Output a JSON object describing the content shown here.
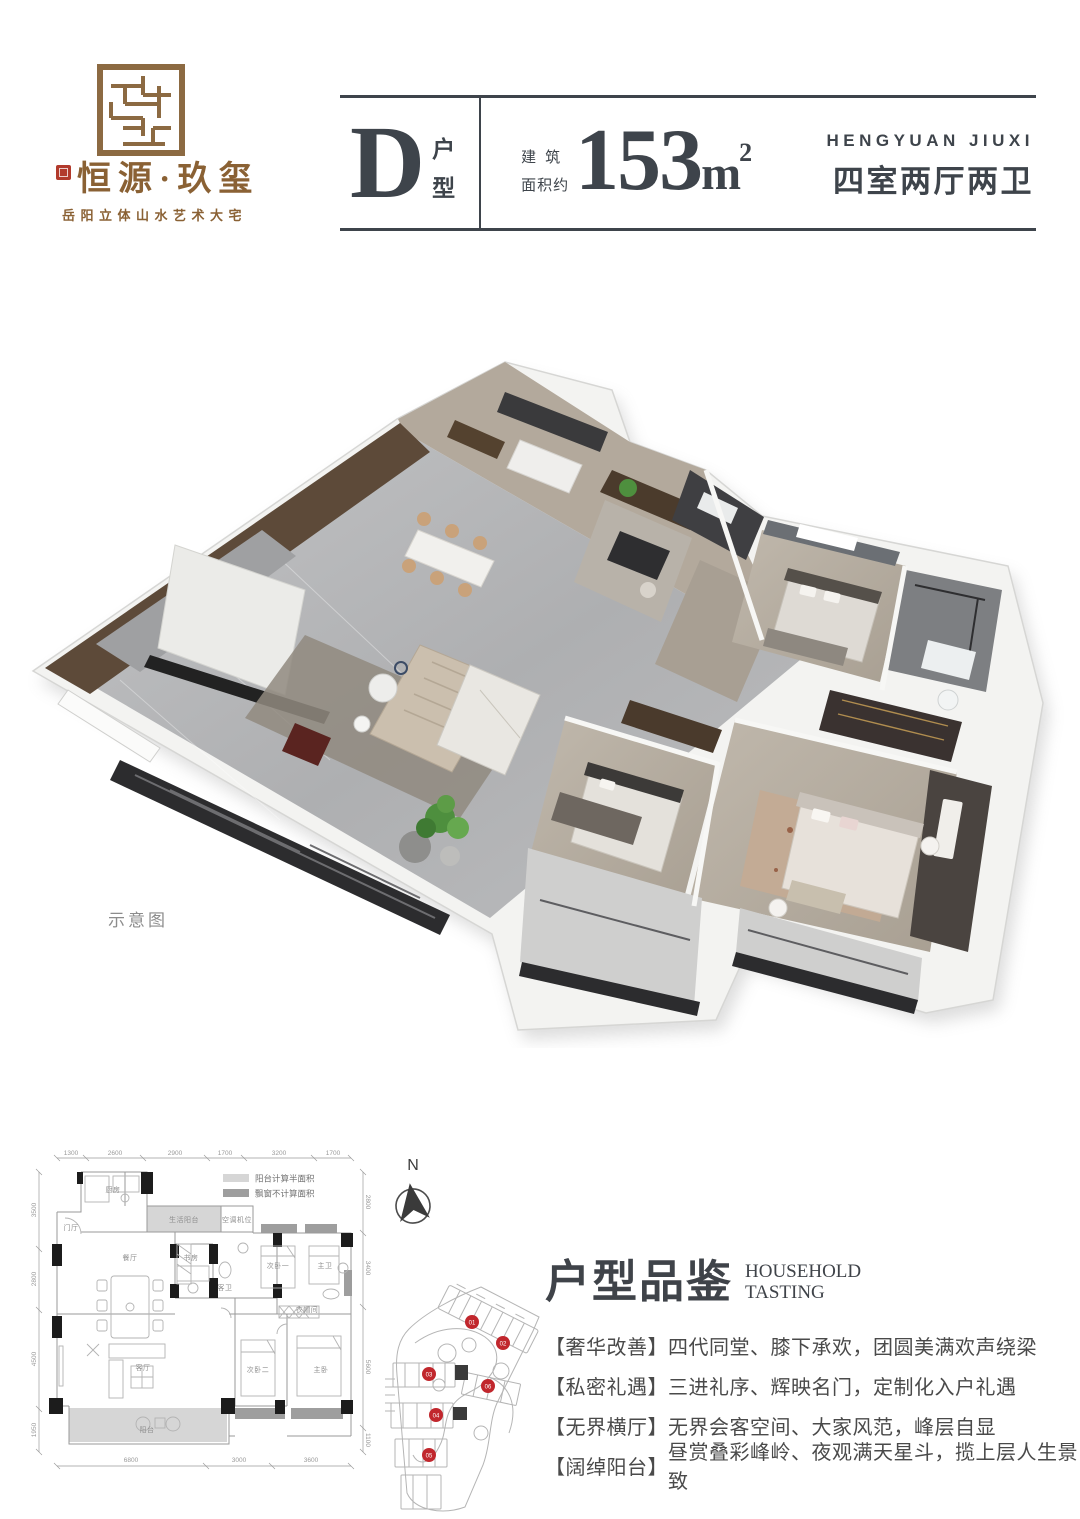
{
  "brand": {
    "logo_text": "恒源·玖玺",
    "tagline": "岳阳立体山水艺术大宅"
  },
  "header": {
    "unit_letter": "D",
    "unit_label_1": "户",
    "unit_label_2": "型",
    "area_prefix_1": "建筑",
    "area_prefix_2": "面积约",
    "area_number": "153",
    "area_unit": "m",
    "area_sup": "2",
    "project_en": "HENGYUAN JIUXI",
    "layout_text": "四室两厅两卫"
  },
  "render": {
    "caption": "示意图"
  },
  "compass": {
    "label": "N"
  },
  "floorplan": {
    "legend": [
      {
        "label": "阳台计算半面积",
        "color": "#d6d6d6"
      },
      {
        "label": "飘窗不计算面积",
        "color": "#9e9e9e"
      }
    ],
    "dims_top": [
      "1300",
      "2600",
      "2900",
      "1700",
      "3200",
      "1700"
    ],
    "dims_bottom": [
      "6800",
      "3000",
      "3600"
    ],
    "dims_left": [
      "3500",
      "2800",
      "4500",
      "1950"
    ],
    "dims_right": [
      "2800",
      "3400",
      "5600",
      "1100"
    ],
    "room_labels": [
      "厨房",
      "生活阳台",
      "空调机位",
      "门厅",
      "餐厅",
      "书房",
      "客卫",
      "次卧一",
      "主卫",
      "客厅",
      "衣帽间",
      "次卧二",
      "主卧",
      "阳台"
    ]
  },
  "siteplan": {
    "badges": [
      "01",
      "02",
      "03",
      "06",
      "04",
      "05"
    ]
  },
  "section": {
    "title_cn": "户型品鉴",
    "title_en_1": "HOUSEHOLD",
    "title_en_2": "TASTING",
    "bullets": [
      {
        "tag": "【奢华改善】",
        "text": "四代同堂、膝下承欢，团圆美满欢声绕梁"
      },
      {
        "tag": "【私密礼遇】",
        "text": "三进礼序、辉映名门，定制化入户礼遇"
      },
      {
        "tag": "【无界横厅】",
        "text": "无界会客空间、大家风范，峰层自显"
      },
      {
        "tag": "【阔绰阳台】",
        "text": "昼赏叠彩峰岭、夜观满天星斗，揽上层人生景致"
      }
    ]
  },
  "colors": {
    "accent_brown": "#8a6134",
    "seal_red": "#b23a2c",
    "badge_red": "#c1272d",
    "ink": "#3e444b",
    "plan_line": "#9a9a9a"
  }
}
